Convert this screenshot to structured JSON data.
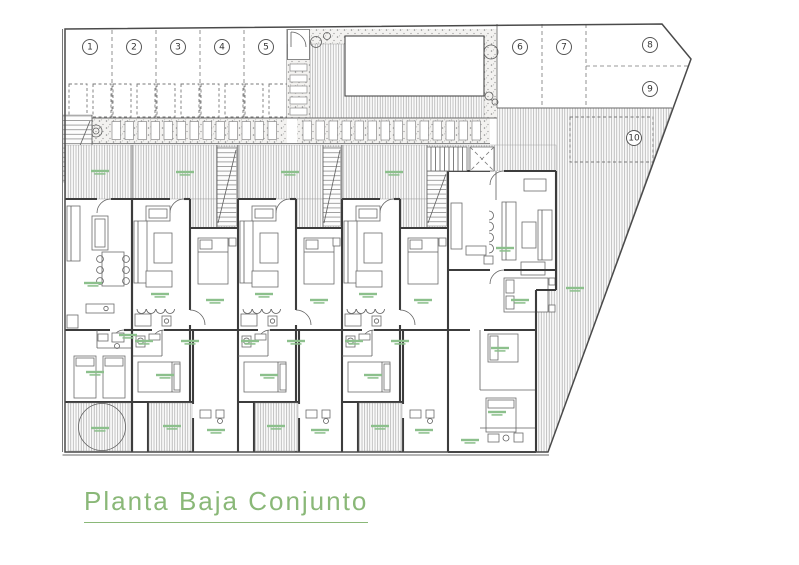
{
  "title": {
    "text": "Planta Baja Conjunto"
  },
  "parking": {
    "spots": [
      "1",
      "2",
      "3",
      "4",
      "5",
      "6",
      "7",
      "8",
      "9",
      "10"
    ]
  },
  "colors": {
    "title_green": "#8ab878",
    "room_label_green": "#8cc08c",
    "line_dark": "#3c3c3c",
    "hatch_gray": "#a9a9a9",
    "stipple_gray": "#969696"
  }
}
